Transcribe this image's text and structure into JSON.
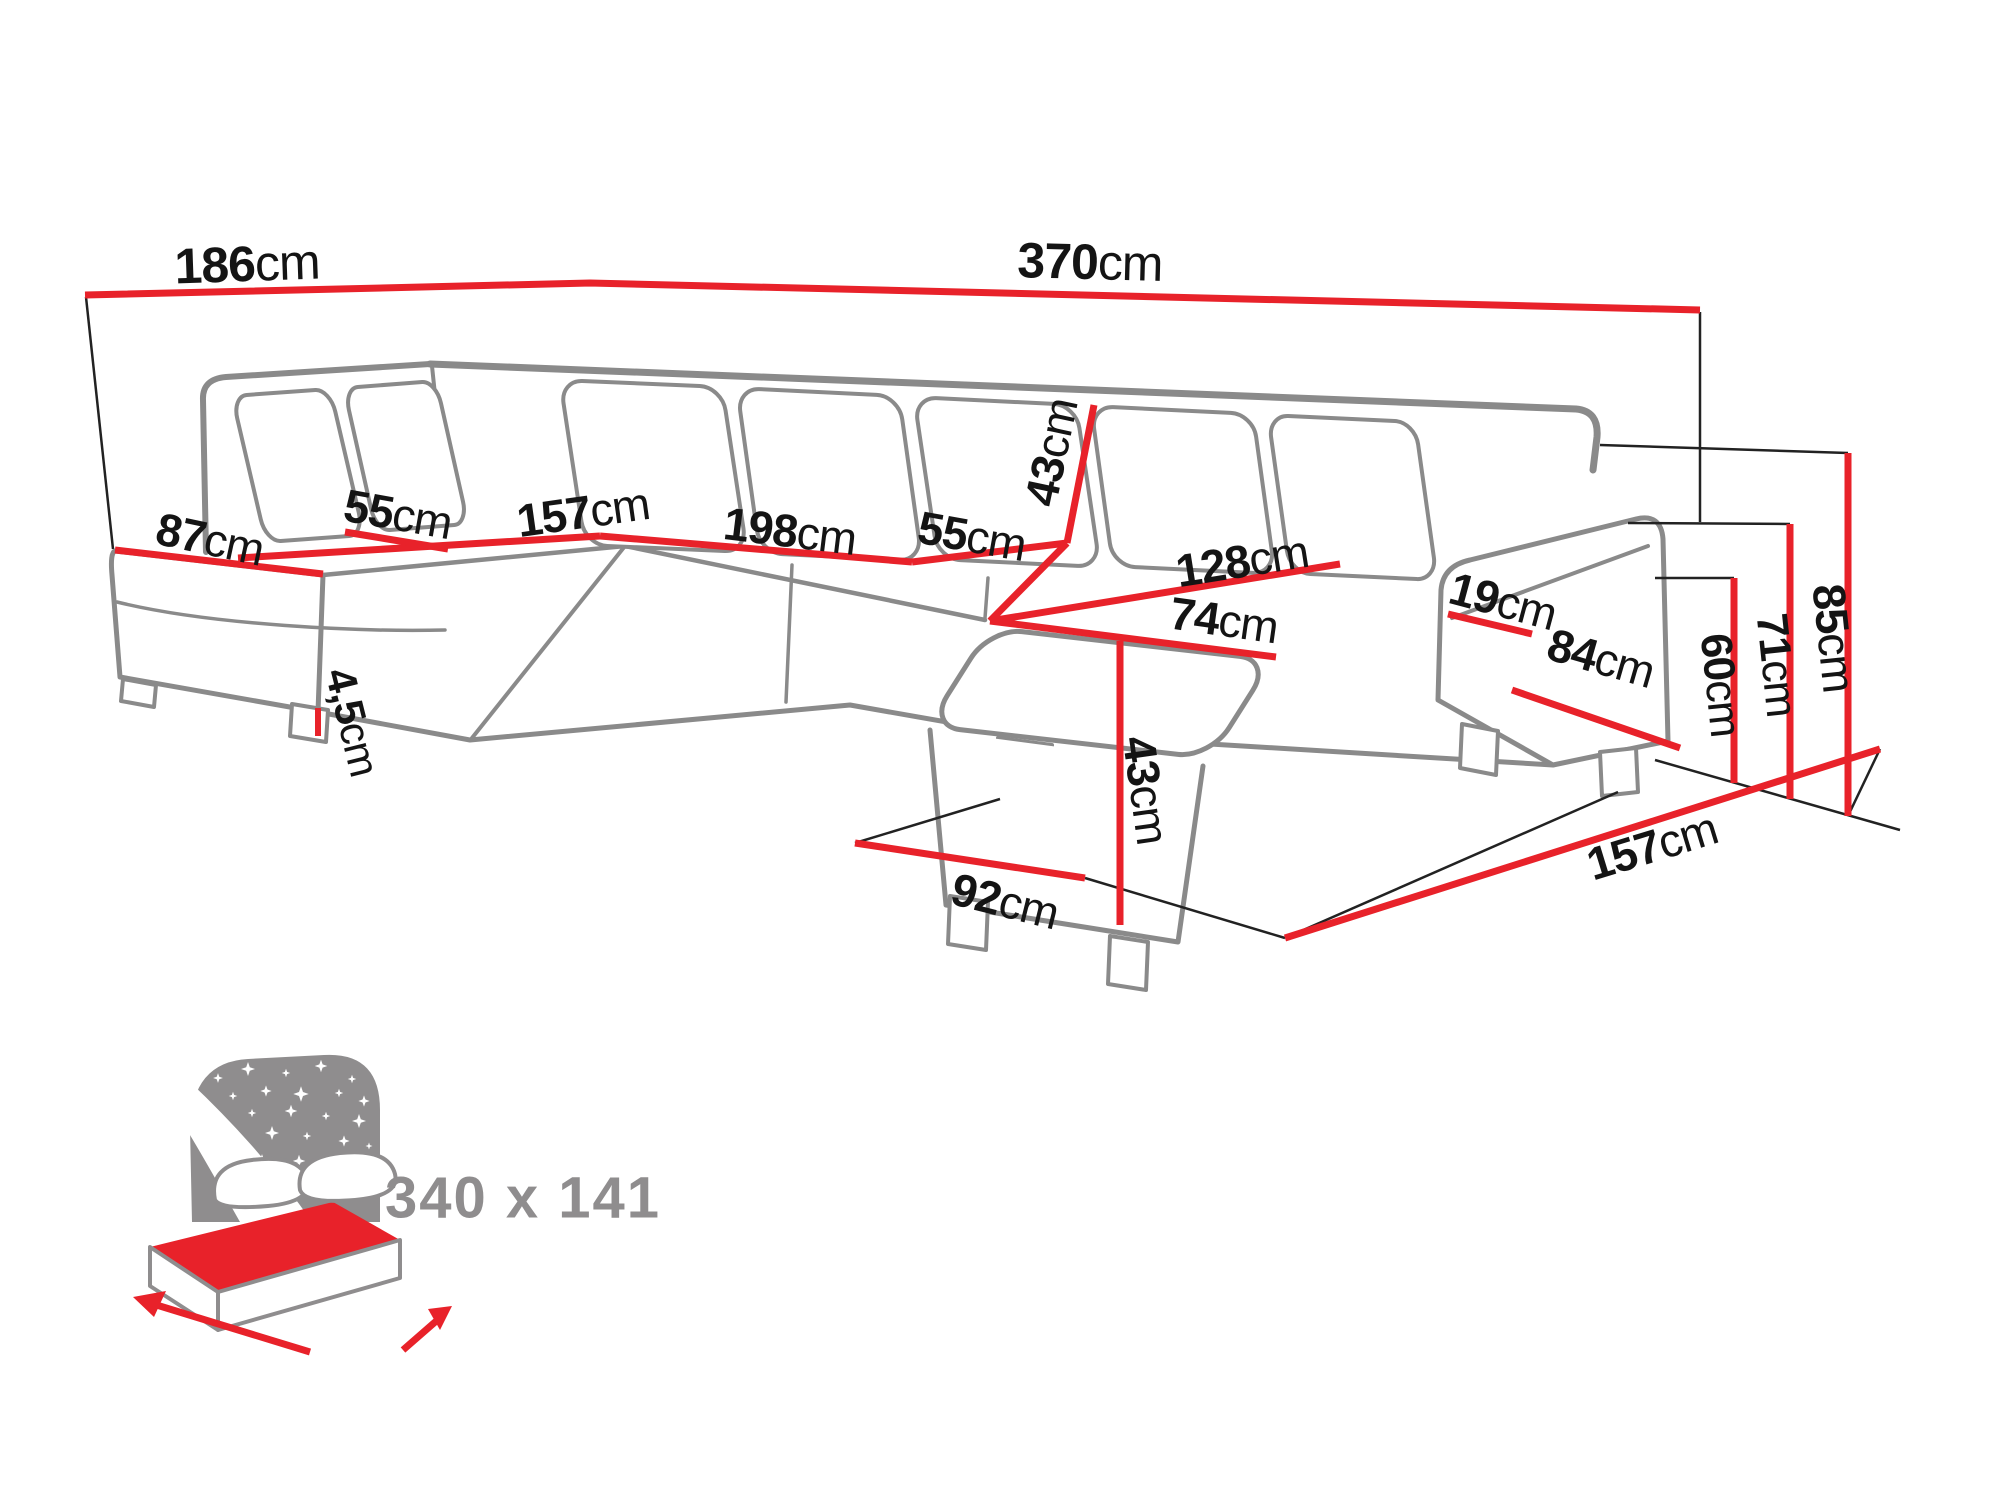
{
  "diagram_type": "corner-sofa dimension drawing",
  "colors": {
    "dimension_line": "#e8222a",
    "outline_gray": "#8a8a8a",
    "thin_line": "#222222",
    "label_text": "#141414",
    "bed_icon_gray": "#8f8d8e"
  },
  "dimensions": {
    "back_left_width": {
      "num": "186",
      "unit": "cm"
    },
    "back_total_width": {
      "num": "370",
      "unit": "cm"
    },
    "left_chaise_depth": {
      "num": "87",
      "unit": "cm"
    },
    "left_backrest_depth": {
      "num": "55",
      "unit": "cm"
    },
    "left_seat_length": {
      "num": "157",
      "unit": "cm"
    },
    "main_seat_length": {
      "num": "198",
      "unit": "cm"
    },
    "main_backrest_depth": {
      "num": "55",
      "unit": "cm"
    },
    "backrest_height": {
      "num": "43",
      "unit": "cm"
    },
    "right_seat_length": {
      "num": "128",
      "unit": "cm"
    },
    "ottoman_width": {
      "num": "74",
      "unit": "cm"
    },
    "armrest_top_width": {
      "num": "19",
      "unit": "cm"
    },
    "armrest_side_length": {
      "num": "84",
      "unit": "cm"
    },
    "ottoman_height": {
      "num": "43",
      "unit": "cm"
    },
    "leg_height": {
      "num": "4,5",
      "unit": "cm"
    },
    "ottoman_floor_length": {
      "num": "92",
      "unit": "cm"
    },
    "right_floor_depth": {
      "num": "157",
      "unit": "cm"
    },
    "seat_height": {
      "num": "60",
      "unit": "cm"
    },
    "armrest_height": {
      "num": "71",
      "unit": "cm"
    },
    "total_height": {
      "num": "85",
      "unit": "cm"
    }
  },
  "bed_icon": {
    "sleeping_area": "340 x 141"
  }
}
